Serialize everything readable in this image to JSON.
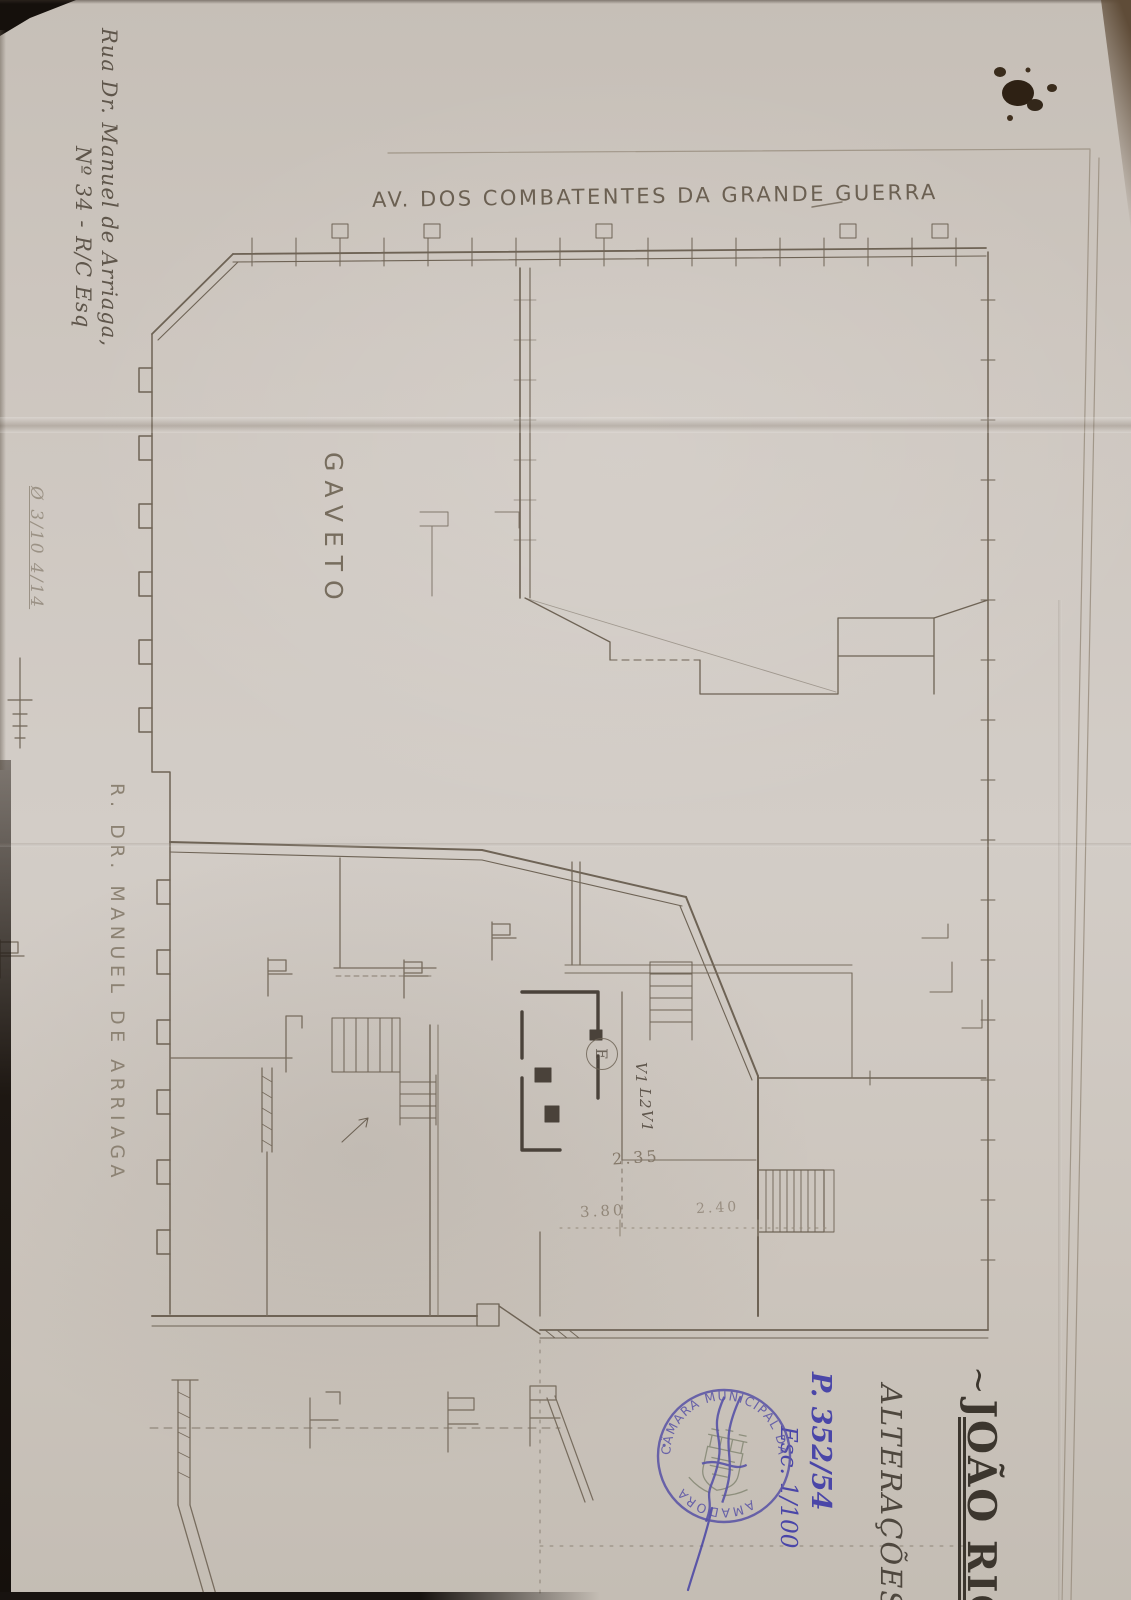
{
  "scan": {
    "street_top_label": "AV. DOS COMBATENTES DA GRANDE GUERRA",
    "corner_label": "GAVETO",
    "street_left_label": "R. DR. MANUEL DE ARRIAGA",
    "address": {
      "line1": "Rua Dr. Manuel de Arriaga,",
      "line2": "Nº 34 - R/C Esq"
    },
    "margin_note": "Ø 3/10 4/14",
    "title": {
      "prefix": "~",
      "name": "JOÃO RIC"
    },
    "subtitle": "ALTERAÇÕES ,",
    "blue_note": {
      "line1": "P. 352/54",
      "line2": "Esc. 1/100"
    },
    "stamp": {
      "arc_top": "CÂMARA MUNICIPAL DA",
      "arc_bottom": "AMADORA",
      "separator": "•"
    },
    "dimensions": {
      "d1": "2.35",
      "d2": "3.80",
      "d3": "2.40"
    },
    "plan_labels": {
      "compartment": "E",
      "vent_top": "V1",
      "shaft": "L2",
      "vent_bottom": "V1"
    },
    "ink": {
      "pencil": "#6e6355",
      "pencil_faint": "#998e7f",
      "pencil_dark": "#4a423a",
      "blue_ink": "#4a46a8",
      "stamp_purple": "#5b55a6",
      "paper": "#cdc6bf"
    }
  }
}
